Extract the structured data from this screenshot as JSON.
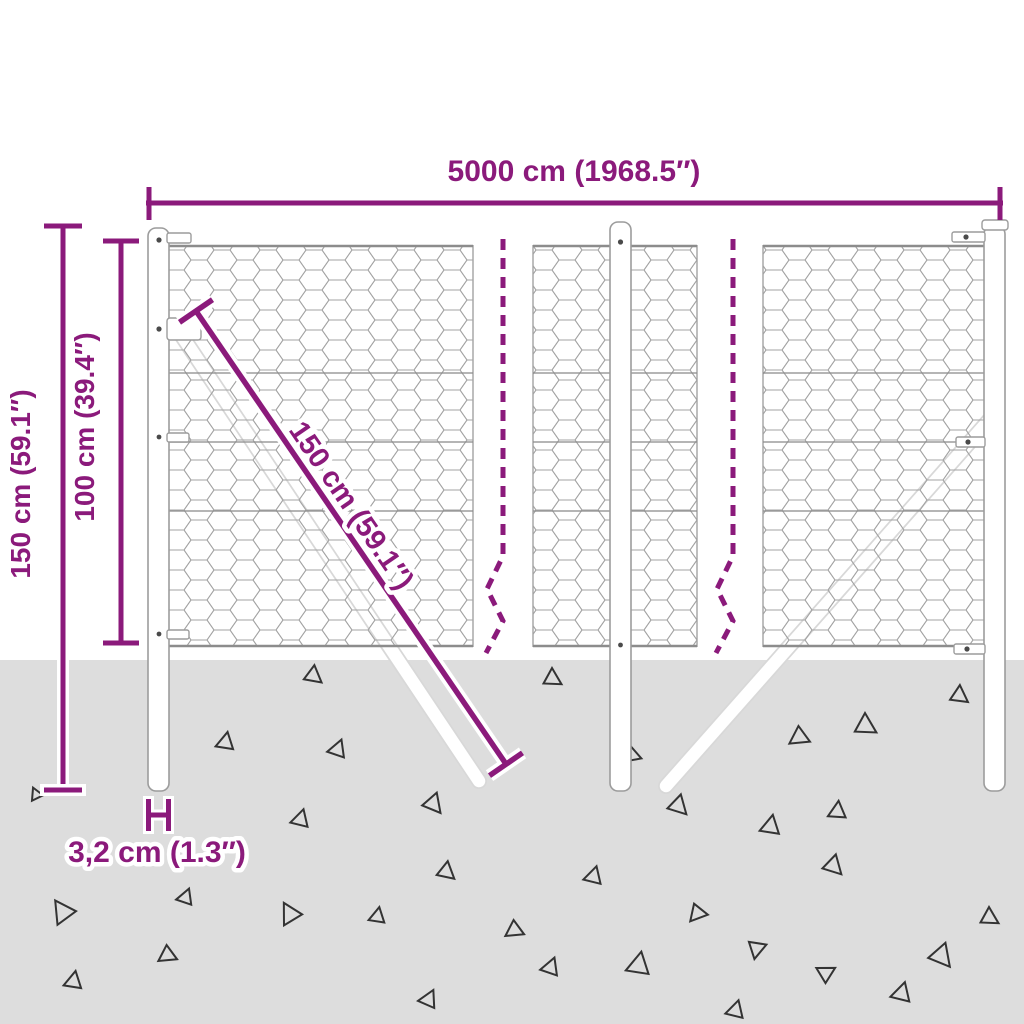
{
  "colors": {
    "accent": "#8B1A7B",
    "ground": "#DDDDDD",
    "mesh": "#A3A3A3",
    "wire": "#8C8C8C",
    "post_outline": "#9C9C9C",
    "triangle": "#333333"
  },
  "dimensions": {
    "total_width": "5000 cm (1968.5″)",
    "total_height": "150 cm (59.1″)",
    "mesh_height": "100 cm (39.4″)",
    "strut_length": "150 cm (59.1″)",
    "post_diameter": "3,2 cm (1.3″)"
  },
  "ground": {
    "triangles": [
      [
        36,
        795,
        7,
        215
      ],
      [
        313,
        675,
        10,
        8
      ],
      [
        552,
        678,
        10,
        0
      ],
      [
        225,
        743,
        10,
        250
      ],
      [
        337,
        750,
        10,
        260
      ],
      [
        433,
        803,
        11,
        20
      ],
      [
        300,
        820,
        10,
        255
      ],
      [
        632,
        755,
        10,
        110
      ],
      [
        678,
        805,
        11,
        15
      ],
      [
        770,
        827,
        11,
        250
      ],
      [
        800,
        737,
        11,
        115
      ],
      [
        865,
        725,
        12,
        0
      ],
      [
        837,
        812,
        10,
        245
      ],
      [
        959,
        695,
        10,
        5
      ],
      [
        446,
        871,
        10,
        10
      ],
      [
        593,
        877,
        10,
        255
      ],
      [
        698,
        913,
        10,
        100
      ],
      [
        515,
        930,
        10,
        115
      ],
      [
        757,
        948,
        10,
        70
      ],
      [
        638,
        966,
        13,
        250
      ],
      [
        550,
        968,
        10,
        260
      ],
      [
        825,
        973,
        10,
        300
      ],
      [
        901,
        994,
        11,
        255
      ],
      [
        941,
        955,
        13,
        20
      ],
      [
        989,
        917,
        10,
        0
      ],
      [
        833,
        865,
        11,
        15
      ],
      [
        428,
        1000,
        10,
        265
      ],
      [
        735,
        1011,
        10,
        255
      ],
      [
        63,
        913,
        13,
        205
      ],
      [
        185,
        898,
        9,
        260
      ],
      [
        290,
        915,
        12,
        210
      ],
      [
        377,
        917,
        9,
        250
      ],
      [
        168,
        955,
        10,
        115
      ],
      [
        73,
        982,
        10,
        250
      ]
    ]
  }
}
